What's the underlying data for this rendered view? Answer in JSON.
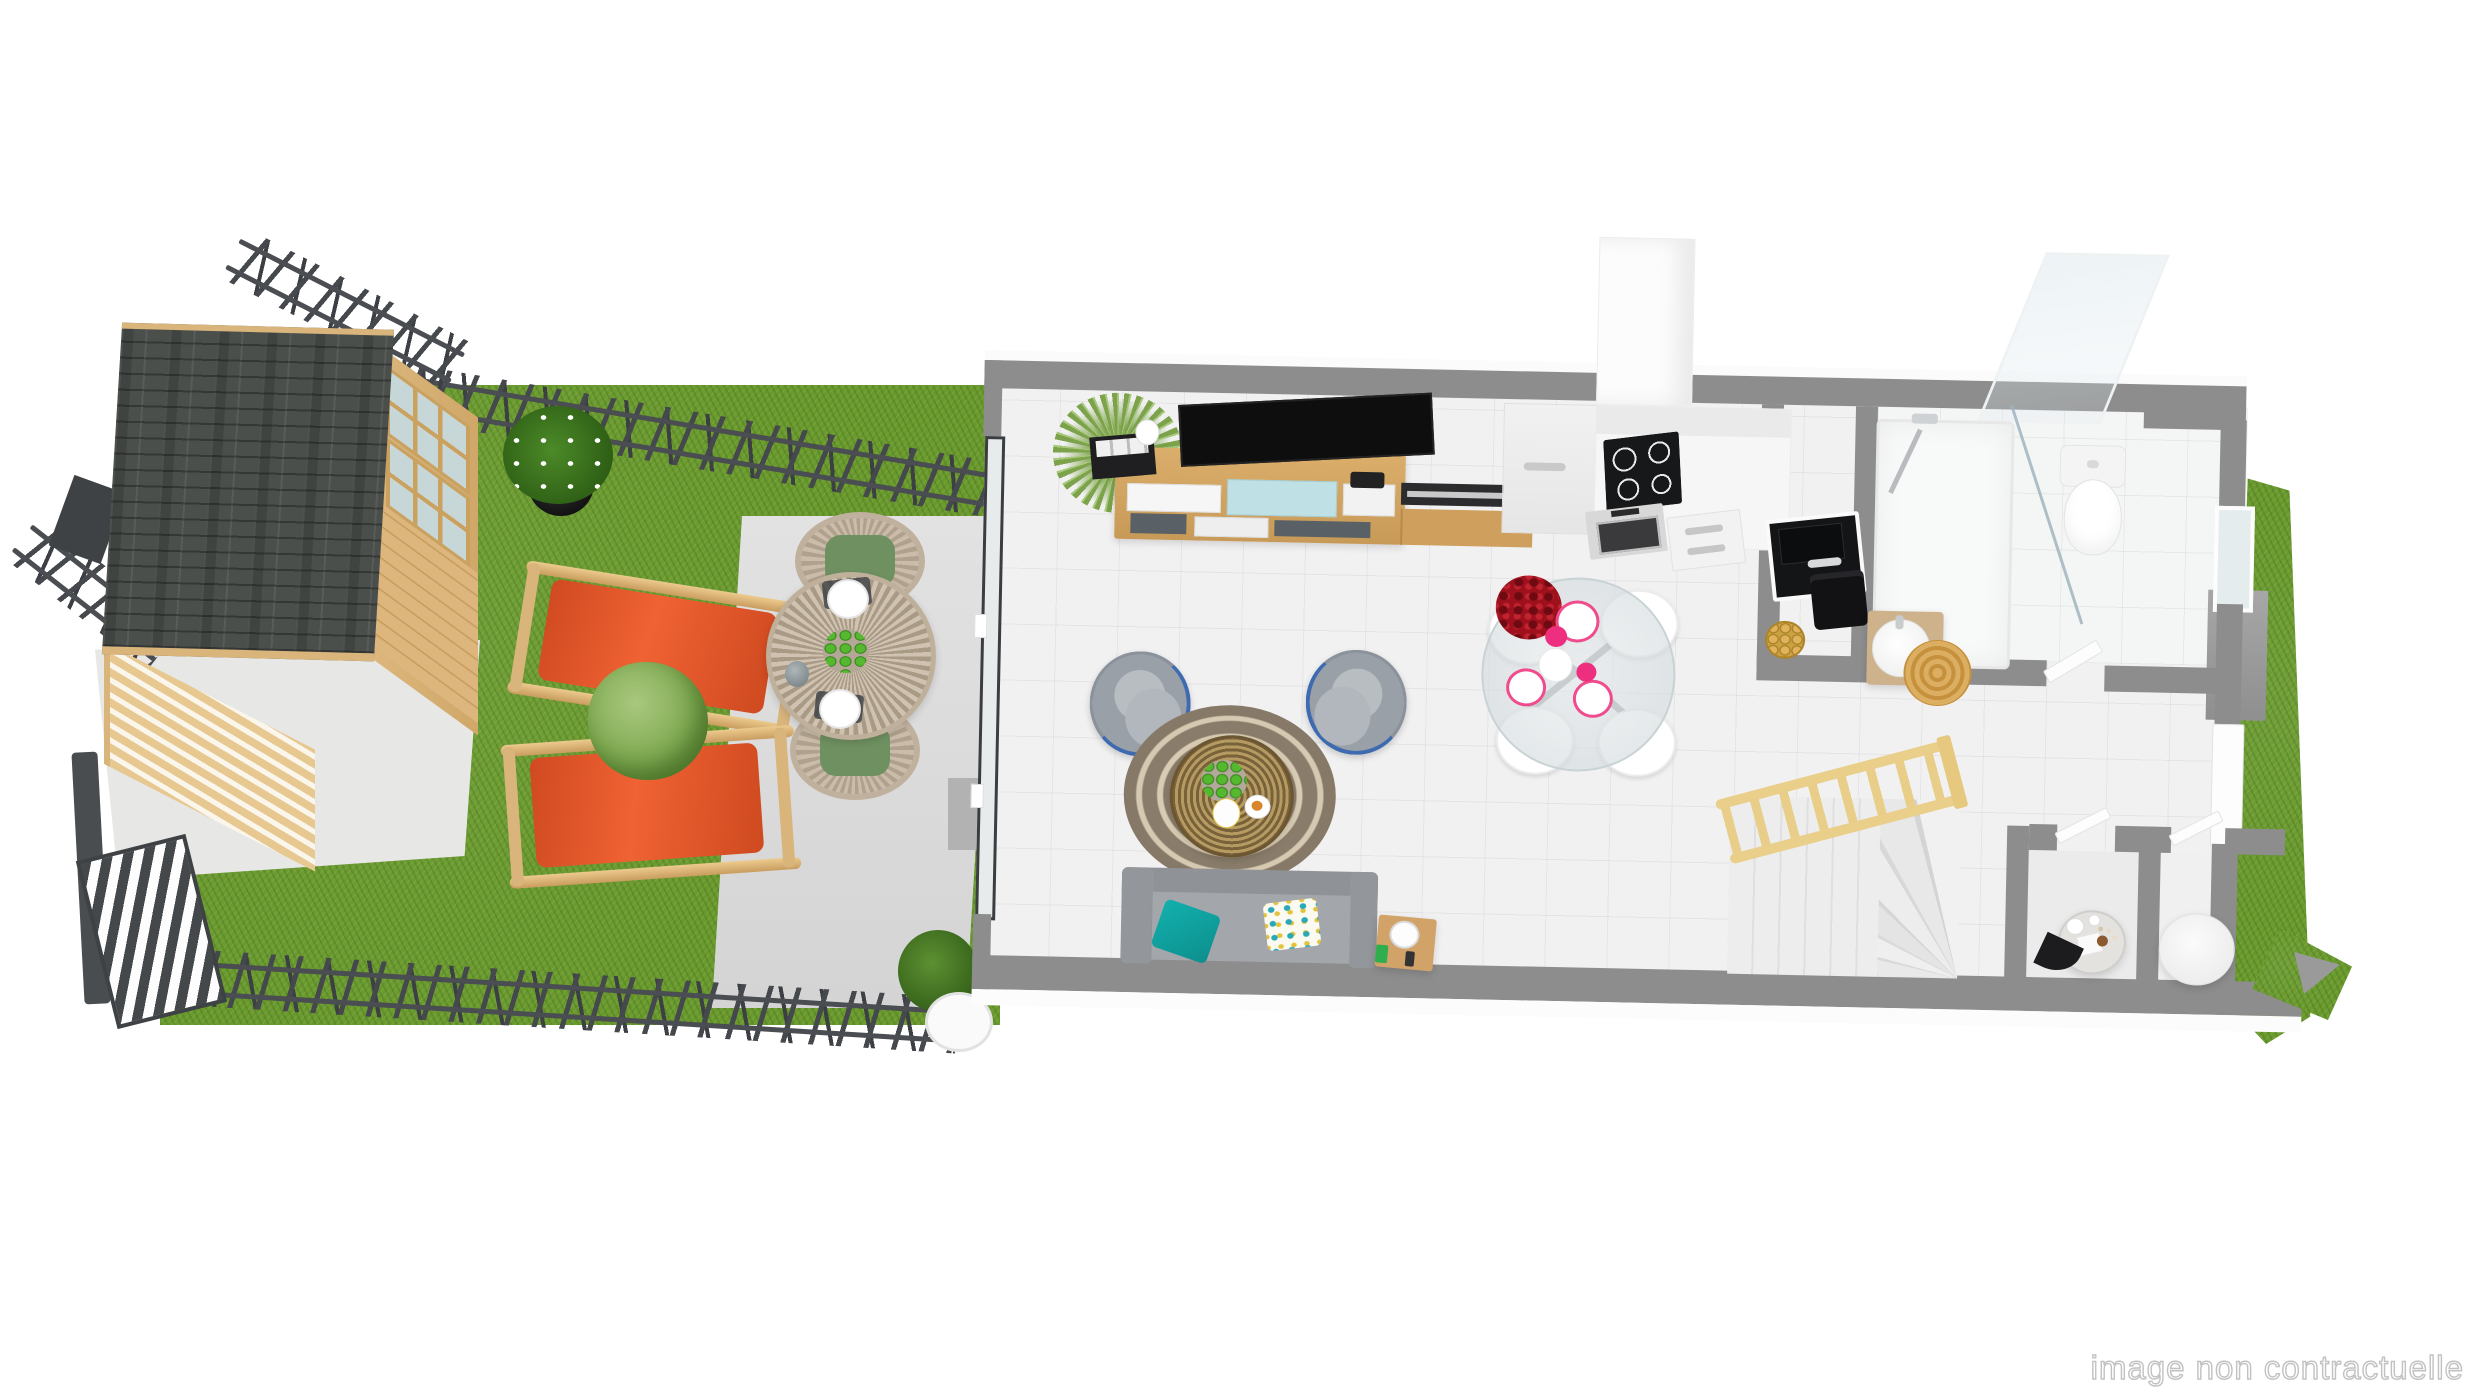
{
  "watermark": "image non contractuelle",
  "scene": {
    "title": "3D top-view floor plan of a ground floor with garden",
    "garden": {
      "ground": [
        "lawn",
        "concrete apron",
        "patio slab"
      ],
      "objects": [
        "wooden garden shed with dark shingle roof",
        "perimeter stick fence",
        "gate panel",
        "potted plant with white flowers",
        "orange deck chair",
        "orange deck chair",
        "round shrub",
        "round slatted outdoor table",
        "outdoor chair with green cushion",
        "outdoor chair with green cushion",
        "bowl of green apples",
        "carafe",
        "two place settings",
        "door step",
        "shrub by entrance",
        "wire plant stand"
      ]
    },
    "house": {
      "rooms": [
        {
          "name": "living-dining room",
          "objects": [
            "tv console with multicolour drawers",
            "flat tv",
            "corner plant",
            "vase with branches",
            "black storage boxes",
            "camera",
            "grey armchair with blue trim",
            "grey armchair with blue trim",
            "round brown-cream rug",
            "rattan drum coffee table",
            "plate of green apples",
            "white vase",
            "coffee cup",
            "grey sofa",
            "teal cushion",
            "floral cushion",
            "wooden side table",
            "lamp",
            "green phone",
            "round glass dining table",
            "white dining chair",
            "white dining chair",
            "white dining chair",
            "white dining chair",
            "red rose bouquet",
            "white teapot",
            "cups with pink saucers",
            "pink coasters"
          ]
        },
        {
          "name": "kitchen",
          "objects": [
            "tall white cabinet",
            "induction hob",
            "oven",
            "drawer unit",
            "white worktop"
          ]
        },
        {
          "name": "utility nook",
          "objects": [
            "black sink with faucet",
            "black bin",
            "bowl of croissants"
          ]
        },
        {
          "name": "bathroom",
          "objects": [
            "walk-in shower",
            "glass screen",
            "shower column",
            "round washbasin on wood vanity",
            "round jute rug",
            "toilet",
            "window"
          ]
        },
        {
          "name": "hallway",
          "objects": [
            "staircase with winder steps",
            "wooden balustrade",
            "white door",
            "exterior door"
          ]
        },
        {
          "name": "small room 1",
          "objects": [
            "round table with tableware",
            "decorative black fan",
            "dried flowers"
          ]
        },
        {
          "name": "small room 2",
          "objects": [
            "large round white pouf"
          ]
        }
      ],
      "exterior": [
        "right lawn strip",
        "grey utility block",
        "right wall window"
      ]
    },
    "palette": {
      "wall": "#8d8d8d",
      "floor": "#f1f1f2",
      "grass": "#69992f",
      "patio": "#dddddd",
      "wood": "#dcb67c",
      "roof": "#4b4f4c",
      "deckchair_orange": "#e0502a",
      "teal": "#12b0ad",
      "armchair_grey": "#9aa0a8",
      "armchair_trim_blue": "#3e6ab0",
      "rug_brown": "#8a7c6a",
      "rug_cream": "#d9ccb4",
      "rattan": "#b59a62",
      "rose_red": "#9e111c",
      "pink": "#ee2f80",
      "apple_green": "#54b92e",
      "balustrade_wood": "#eacf8b",
      "fence": "#45484c",
      "watermark_grey": "#c2c2c2"
    }
  }
}
